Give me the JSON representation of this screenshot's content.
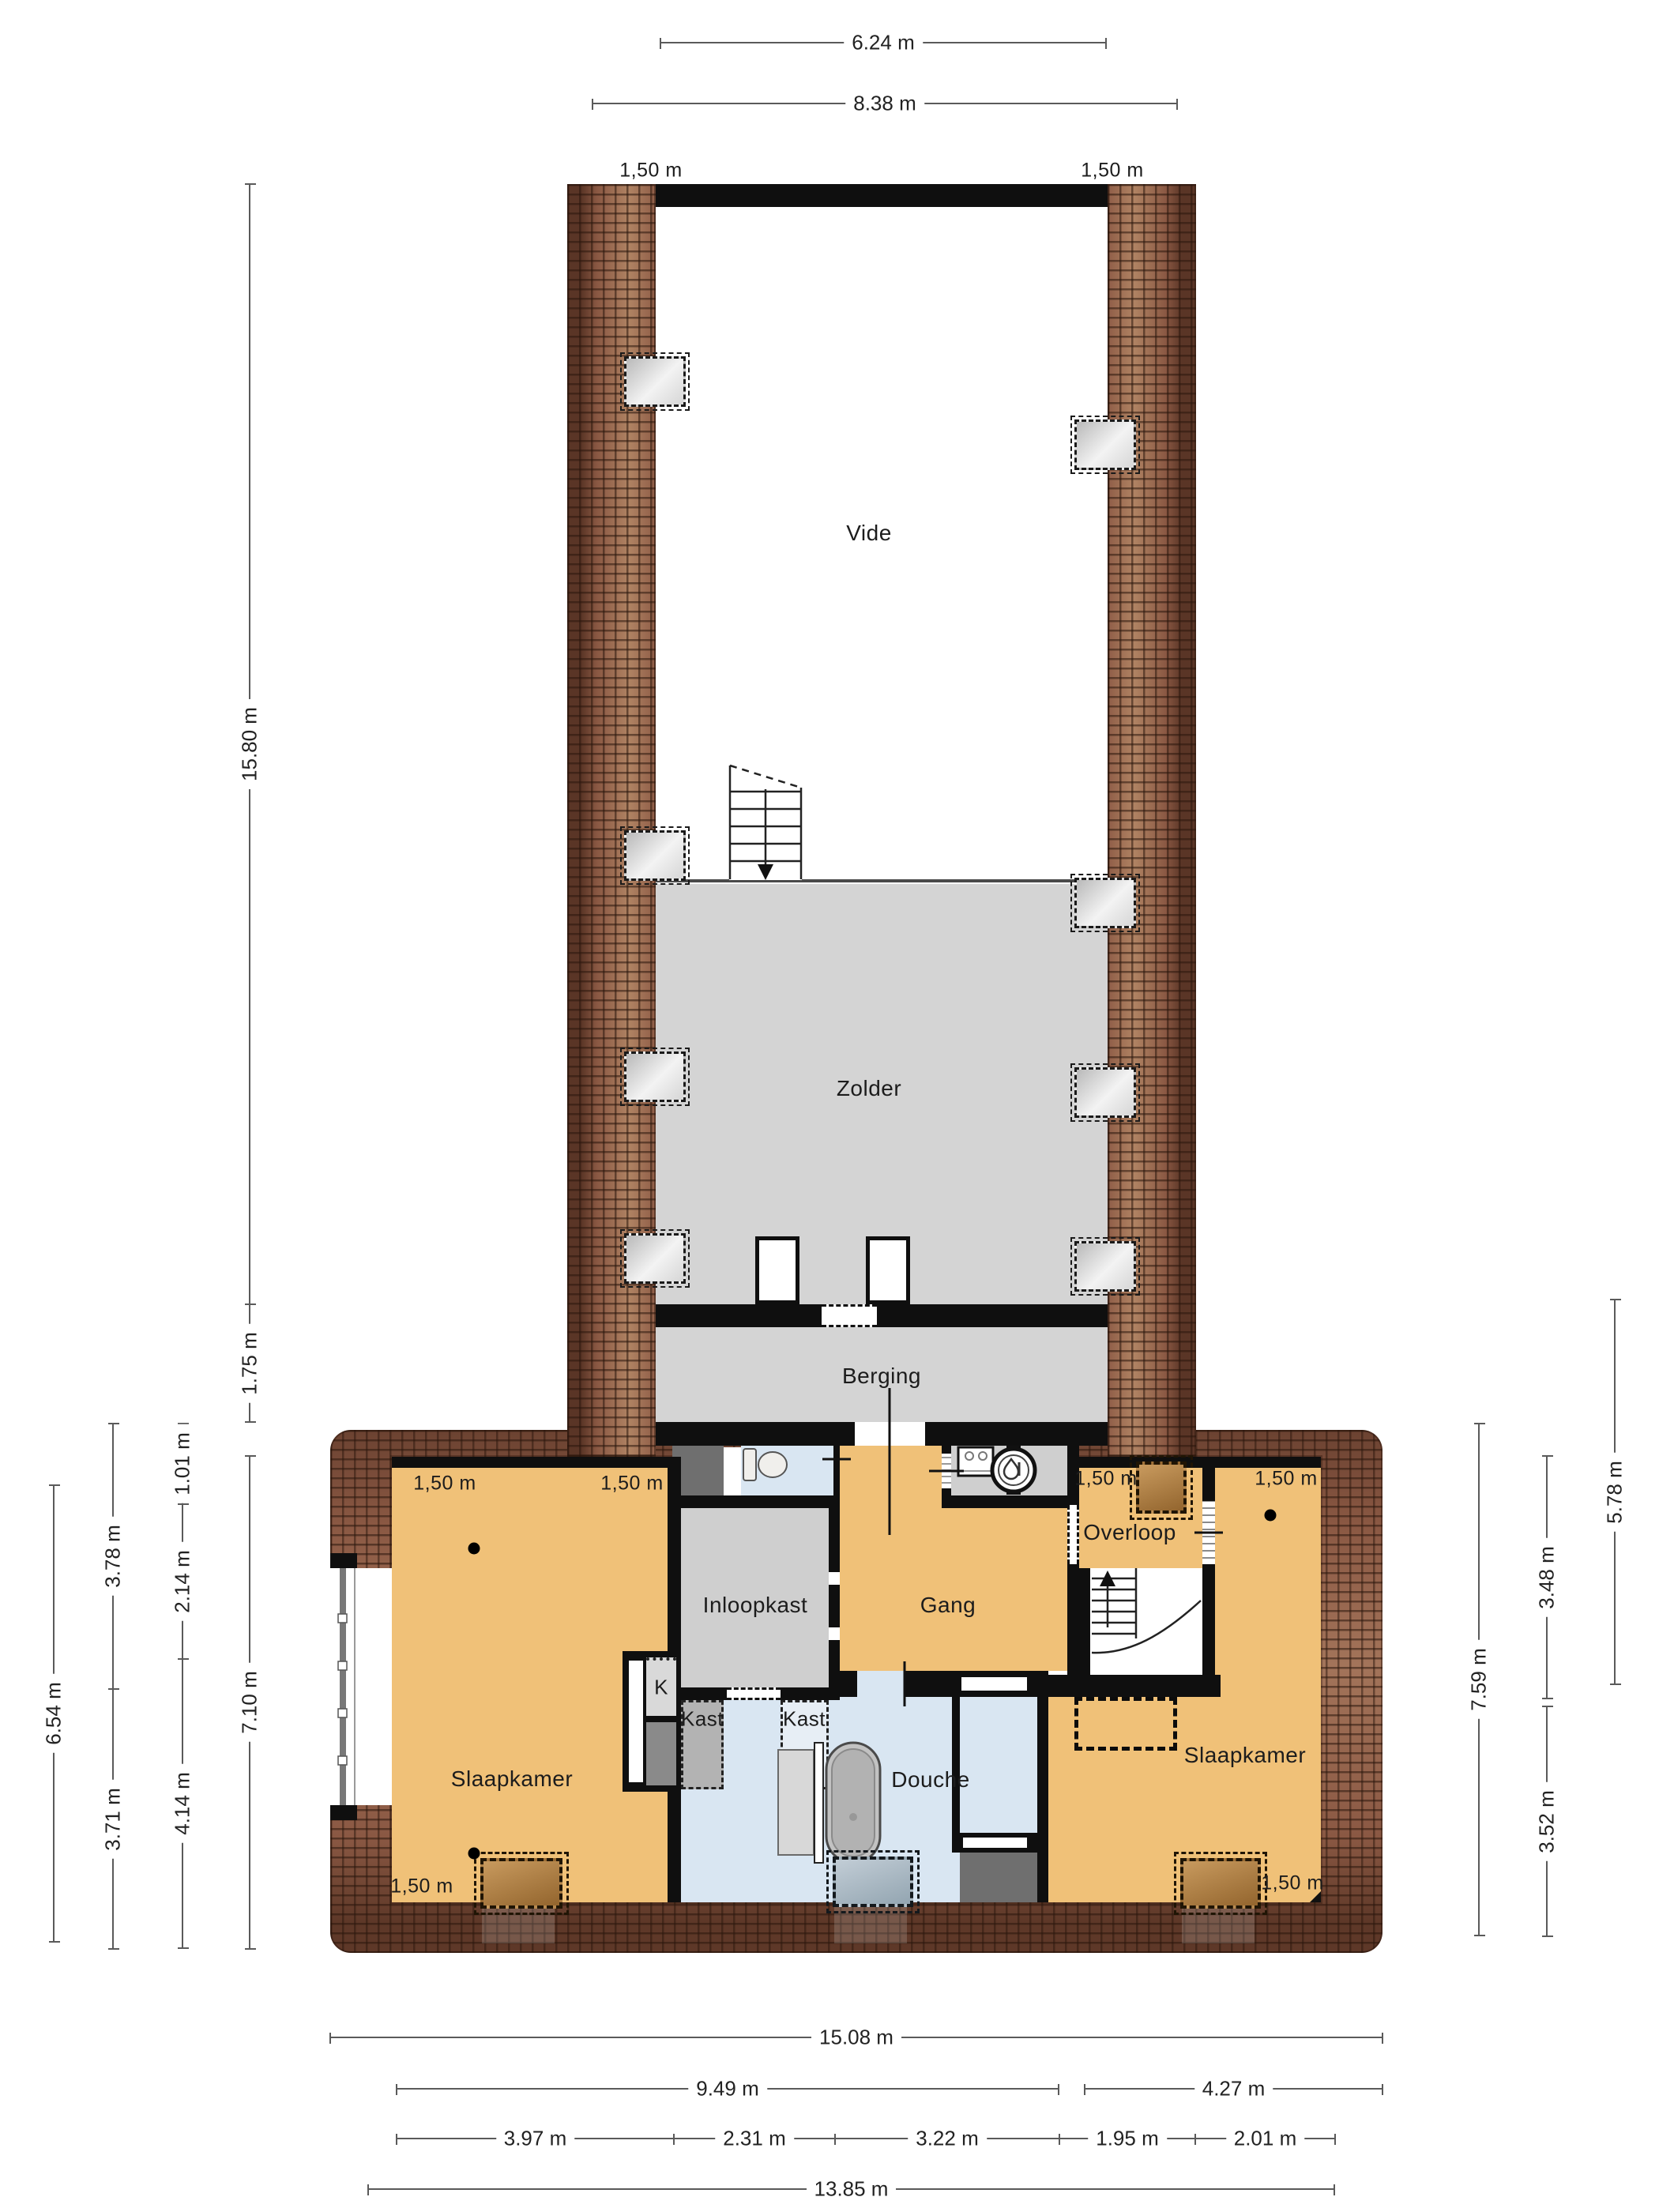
{
  "rooms": {
    "vide": "Vide",
    "zolder": "Zolder",
    "berging": "Berging",
    "slaapkamer_left": "Slaapkamer",
    "slaapkamer_right": "Slaapkamer",
    "inloopkast": "Inloopkast",
    "gang": "Gang",
    "overloop": "Overloop",
    "douche": "Douche",
    "kast_k": "K",
    "kast_left": "Kast",
    "kast_right": "Kast"
  },
  "headroom_label": "1,50 m",
  "dimensions": {
    "top": [
      "6.24 m",
      "8.38 m"
    ],
    "left": [
      "15.80 m",
      "1.75 m",
      "6.54 m",
      "3.78 m",
      "3.71 m",
      "1.01 m",
      "2.14 m",
      "4.14 m",
      "7.10 m"
    ],
    "right": [
      "5.78 m",
      "3.48 m",
      "3.52 m",
      "7.59 m"
    ],
    "bottom": [
      "15.08 m",
      "9.49 m",
      "4.27 m",
      "3.97 m",
      "2.31 m",
      "3.22 m",
      "1.95 m",
      "2.01 m",
      "13.85 m"
    ]
  },
  "icons": {
    "stairs_down": "stairs-down-arrow-icon",
    "stairs_up": "stairs-up-arrow-icon",
    "toilet": "toilet-icon",
    "bathtub": "bathtub-icon",
    "vanity": "vanity-cabinet-icon",
    "washing_machine": "washing-machine-icon",
    "boiler": "boiler-icon",
    "roof_window": "roof-window-dashed-icon",
    "skylight": "skylight-dashed-icon",
    "ceiling_spot": "ceiling-spot-dot-icon"
  },
  "colors": {
    "wall": "#0f0f0f",
    "room_orange": "#f0c178",
    "room_blue": "#d9e6f2",
    "room_gray": "#cfcfcf",
    "room_dark_gray": "#6f6f6f",
    "roof_tile": "#96654d",
    "dimension_line": "#5a5a5a",
    "floor_white": "#ffffff"
  }
}
